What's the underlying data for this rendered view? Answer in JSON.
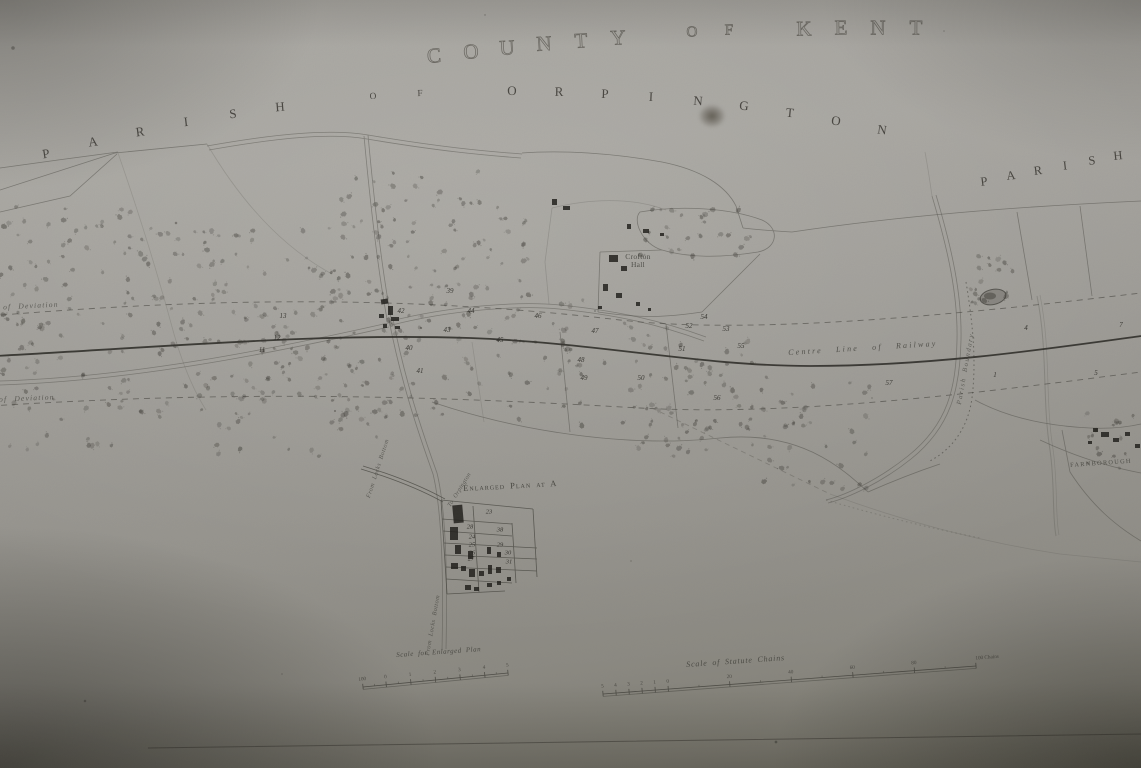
{
  "meta": {
    "description": "Photograph of an antique deposited railway plan, County of Kent, Parish of Orpington"
  },
  "arc_texts": [
    {
      "name": "title-county-of-kent",
      "text": "COUNTY OF KENT",
      "p": [
        434,
        56,
        672,
        26,
        916,
        28
      ],
      "size": 21,
      "cls": "county-char"
    },
    {
      "name": "title-parish-of-orpington",
      "text": "PARISH OF ORPINGTON",
      "p": [
        46,
        154,
        468,
        42,
        882,
        130
      ],
      "size": 13,
      "cls": "parish-char"
    },
    {
      "name": "title-parish-right",
      "text": "PARISH",
      "p": [
        984,
        182,
        1052,
        168,
        1118,
        156
      ],
      "size": 12.5,
      "cls": "parish-char"
    }
  ],
  "map_labels": [
    {
      "name": "label-centre-line-of-railway",
      "text": "Centre Line of Railway",
      "x": 788,
      "y": 349,
      "rot": -3.5,
      "size": 8,
      "ls": 2.2,
      "ws": 9,
      "italic": true,
      "op": 0.8
    },
    {
      "name": "label-limit-of-deviation-upper",
      "text": "Limit of Deviation",
      "x": -26,
      "y": 305,
      "rot": -3,
      "size": 7.5,
      "ls": 1.2,
      "ws": 4,
      "italic": true,
      "op": 0.72
    },
    {
      "name": "label-limit-of-deviation-lower",
      "text": "Limit of Deviation",
      "x": -30,
      "y": 397,
      "rot": -2.5,
      "size": 7.5,
      "ls": 1.2,
      "ws": 4,
      "italic": true,
      "op": 0.72
    },
    {
      "name": "label-crofton-hall",
      "text": "Crofton Hall",
      "x": 620,
      "y": 253,
      "rot": 0,
      "size": 7.5,
      "ls": 0.3,
      "italic": false,
      "op": 0.85,
      "w": 36
    },
    {
      "name": "label-farnborough",
      "text": "FARNBOROUGH",
      "x": 1070,
      "y": 463,
      "rot": -4,
      "size": 6.3,
      "ls": 1.3,
      "italic": false,
      "op": 0.8
    },
    {
      "name": "label-parish-boundary",
      "text": "Parish Boundary",
      "x": 956,
      "y": 404,
      "rot": -80,
      "size": 6.8,
      "ls": 1.6,
      "italic": true,
      "op": 0.68
    },
    {
      "name": "label-from-locks-bottom-1",
      "text": "From Locks Bottom",
      "x": 366,
      "y": 497,
      "rot": -72,
      "size": 6.2,
      "ls": 0.5,
      "italic": true,
      "op": 0.7
    },
    {
      "name": "label-from-locks-bottom-2",
      "text": "From Locks Bottom",
      "x": 425,
      "y": 655,
      "rot": -80,
      "size": 6.2,
      "ls": 0.5,
      "italic": true,
      "op": 0.7
    },
    {
      "name": "label-to-orpington",
      "text": "To Orpington",
      "x": 447,
      "y": 505,
      "rot": -58,
      "size": 6,
      "ls": 0.4,
      "italic": true,
      "op": 0.7
    },
    {
      "name": "label-enlarged-plan-title",
      "text": "Enlarged Plan at A",
      "x": 463,
      "y": 484,
      "rot": -3,
      "size": 8.5,
      "ls": 1,
      "italic": false,
      "op": 0.9,
      "sc": true
    },
    {
      "name": "label-scale-enlarged-plan",
      "text": "Scale for Enlarged Plan",
      "x": 396,
      "y": 652,
      "rot": -4,
      "size": 7,
      "ls": 0.5,
      "italic": true,
      "op": 0.8
    },
    {
      "name": "label-scale-statute-chains",
      "text": "Scale of Statute Chains",
      "x": 686,
      "y": 661,
      "rot": -4,
      "size": 8,
      "ls": 0.8,
      "italic": true,
      "op": 0.8
    }
  ],
  "field_numbers": [
    {
      "n": "42",
      "x": 401,
      "y": 311
    },
    {
      "n": "39",
      "x": 450,
      "y": 291
    },
    {
      "n": "40",
      "x": 409,
      "y": 348
    },
    {
      "n": "41",
      "x": 420,
      "y": 371
    },
    {
      "n": "44",
      "x": 471,
      "y": 311
    },
    {
      "n": "46",
      "x": 538,
      "y": 316
    },
    {
      "n": "47",
      "x": 595,
      "y": 331
    },
    {
      "n": "48",
      "x": 581,
      "y": 360
    },
    {
      "n": "49",
      "x": 584,
      "y": 378
    },
    {
      "n": "50",
      "x": 641,
      "y": 378
    },
    {
      "n": "51",
      "x": 682,
      "y": 349
    },
    {
      "n": "52",
      "x": 689,
      "y": 326
    },
    {
      "n": "53",
      "x": 726,
      "y": 329
    },
    {
      "n": "54",
      "x": 704,
      "y": 317
    },
    {
      "n": "55",
      "x": 741,
      "y": 346
    },
    {
      "n": "56",
      "x": 717,
      "y": 398
    },
    {
      "n": "57",
      "x": 889,
      "y": 383
    },
    {
      "n": "4",
      "x": 1026,
      "y": 328
    },
    {
      "n": "7",
      "x": 1121,
      "y": 325
    },
    {
      "n": "1",
      "x": 995,
      "y": 375
    },
    {
      "n": "5",
      "x": 1096,
      "y": 373
    },
    {
      "n": "13",
      "x": 283,
      "y": 316
    },
    {
      "n": "11",
      "x": 262,
      "y": 350
    },
    {
      "n": "12",
      "x": 277,
      "y": 338
    },
    {
      "n": "45",
      "x": 500,
      "y": 340
    },
    {
      "n": "43",
      "x": 447,
      "y": 330
    }
  ],
  "enlarged_plan": {
    "numbers": [
      {
        "n": "23",
        "x": 489,
        "y": 512
      },
      {
        "n": "28",
        "x": 470,
        "y": 527
      },
      {
        "n": "38",
        "x": 500,
        "y": 530
      },
      {
        "n": "24",
        "x": 472,
        "y": 537
      },
      {
        "n": "25",
        "x": 472,
        "y": 545
      },
      {
        "n": "29",
        "x": 500,
        "y": 545
      },
      {
        "n": "26",
        "x": 472,
        "y": 553
      },
      {
        "n": "30",
        "x": 508,
        "y": 553
      },
      {
        "n": "27",
        "x": 471,
        "y": 559
      },
      {
        "n": "31",
        "x": 509,
        "y": 562
      }
    ]
  },
  "scale_bars": [
    {
      "name": "scale-bar-enlarged-plan",
      "x0": 363,
      "y0": 687,
      "x1": 508,
      "y1": 673,
      "ticks": [
        {
          "t": 0,
          "l": "100"
        },
        {
          "t": 0.16,
          "l": "0"
        },
        {
          "t": 0.33,
          "l": "1"
        },
        {
          "t": 0.5,
          "l": "2"
        },
        {
          "t": 0.67,
          "l": "3"
        },
        {
          "t": 0.84,
          "l": "4"
        },
        {
          "t": 1,
          "l": "5"
        }
      ]
    },
    {
      "name": "scale-bar-statute-chains",
      "x0": 603,
      "y0": 694,
      "x1": 976,
      "y1": 666,
      "ticks": [
        {
          "t": 0,
          "l": "5"
        },
        {
          "t": 0.035,
          "l": "4"
        },
        {
          "t": 0.07,
          "l": "3"
        },
        {
          "t": 0.105,
          "l": "2"
        },
        {
          "t": 0.14,
          "l": "1"
        },
        {
          "t": 0.175,
          "l": "0"
        },
        {
          "t": 0.34,
          "l": "20"
        },
        {
          "t": 0.505,
          "l": "40"
        },
        {
          "t": 0.67,
          "l": "60"
        },
        {
          "t": 0.835,
          "l": "80"
        },
        {
          "t": 1,
          "l": "100 Chains"
        }
      ]
    }
  ],
  "woodland_bands": [
    {
      "x": 0,
      "y": 205,
      "w": 145,
      "h": 95,
      "n": 38
    },
    {
      "x": 120,
      "y": 228,
      "w": 230,
      "h": 190,
      "n": 150
    },
    {
      "x": 335,
      "y": 170,
      "w": 195,
      "h": 155,
      "n": 100
    },
    {
      "x": 340,
      "y": 325,
      "w": 190,
      "h": 95,
      "n": 55
    },
    {
      "x": 0,
      "y": 298,
      "w": 125,
      "h": 112,
      "n": 42
    },
    {
      "x": 525,
      "y": 300,
      "w": 60,
      "h": 90,
      "n": 14
    },
    {
      "x": 640,
      "y": 208,
      "w": 135,
      "h": 50,
      "n": 26
    },
    {
      "x": 975,
      "y": 252,
      "w": 45,
      "h": 52,
      "n": 12
    },
    {
      "x": 963,
      "y": 288,
      "w": 22,
      "h": 18,
      "n": 6
    },
    {
      "x": 1082,
      "y": 412,
      "w": 58,
      "h": 62,
      "n": 16
    },
    {
      "x": 208,
      "y": 410,
      "w": 185,
      "h": 48,
      "n": 16
    },
    {
      "x": 0,
      "y": 405,
      "w": 160,
      "h": 45,
      "n": 14
    },
    {
      "x": 558,
      "y": 320,
      "w": 112,
      "h": 108,
      "n": 30
    },
    {
      "x": 650,
      "y": 340,
      "w": 120,
      "h": 110,
      "n": 45
    },
    {
      "x": 758,
      "y": 378,
      "w": 112,
      "h": 112,
      "n": 35
    },
    {
      "x": 636,
      "y": 418,
      "w": 84,
      "h": 42,
      "n": 12
    }
  ],
  "buildings": {
    "main": [
      [
        381,
        299,
        7,
        5,
        -8
      ],
      [
        388,
        306,
        5,
        9,
        0
      ],
      [
        379,
        314,
        5,
        4,
        0
      ],
      [
        391,
        317,
        8,
        4,
        0
      ],
      [
        383,
        324,
        4,
        4,
        0
      ],
      [
        395,
        326,
        5,
        3,
        0
      ],
      [
        552,
        199,
        5,
        6,
        0
      ],
      [
        563,
        206,
        7,
        4,
        0
      ],
      [
        627,
        224,
        4,
        5,
        0
      ],
      [
        643,
        229,
        6,
        4,
        0
      ],
      [
        660,
        233,
        4,
        3,
        0
      ],
      [
        609,
        255,
        9,
        7,
        0
      ],
      [
        621,
        266,
        6,
        5,
        0
      ],
      [
        603,
        284,
        5,
        7,
        0
      ],
      [
        616,
        293,
        6,
        5,
        0
      ],
      [
        636,
        302,
        4,
        4,
        0
      ],
      [
        648,
        308,
        3,
        3,
        0
      ],
      [
        598,
        306,
        4,
        3,
        0
      ],
      [
        1093,
        428,
        5,
        4,
        0
      ],
      [
        1101,
        432,
        8,
        5,
        0
      ],
      [
        1113,
        438,
        6,
        4,
        0
      ],
      [
        1125,
        432,
        5,
        4,
        0
      ],
      [
        1088,
        441,
        4,
        3,
        0
      ],
      [
        1135,
        444,
        5,
        4,
        0
      ]
    ],
    "enlarged": [
      [
        453,
        505,
        10,
        18,
        -5
      ],
      [
        450,
        527,
        8,
        13,
        0
      ],
      [
        455,
        545,
        6,
        9,
        0
      ],
      [
        468,
        551,
        5,
        8,
        0
      ],
      [
        451,
        563,
        7,
        6,
        0
      ],
      [
        461,
        566,
        5,
        5,
        0
      ],
      [
        469,
        569,
        6,
        8,
        0
      ],
      [
        479,
        571,
        5,
        5,
        0
      ],
      [
        488,
        565,
        4,
        9,
        0
      ],
      [
        496,
        567,
        5,
        6,
        0
      ],
      [
        487,
        547,
        4,
        7,
        0
      ],
      [
        497,
        552,
        4,
        5,
        0
      ],
      [
        465,
        585,
        6,
        5,
        0
      ],
      [
        474,
        587,
        5,
        4,
        0
      ],
      [
        487,
        583,
        5,
        4,
        0
      ],
      [
        497,
        581,
        4,
        4,
        0
      ],
      [
        507,
        577,
        4,
        4,
        0
      ]
    ]
  },
  "colors": {
    "paper": "#9e9c97",
    "ink": "#3c3b36",
    "railway": "#2c2b27",
    "building": "rgba(28,27,23,0.82)"
  }
}
